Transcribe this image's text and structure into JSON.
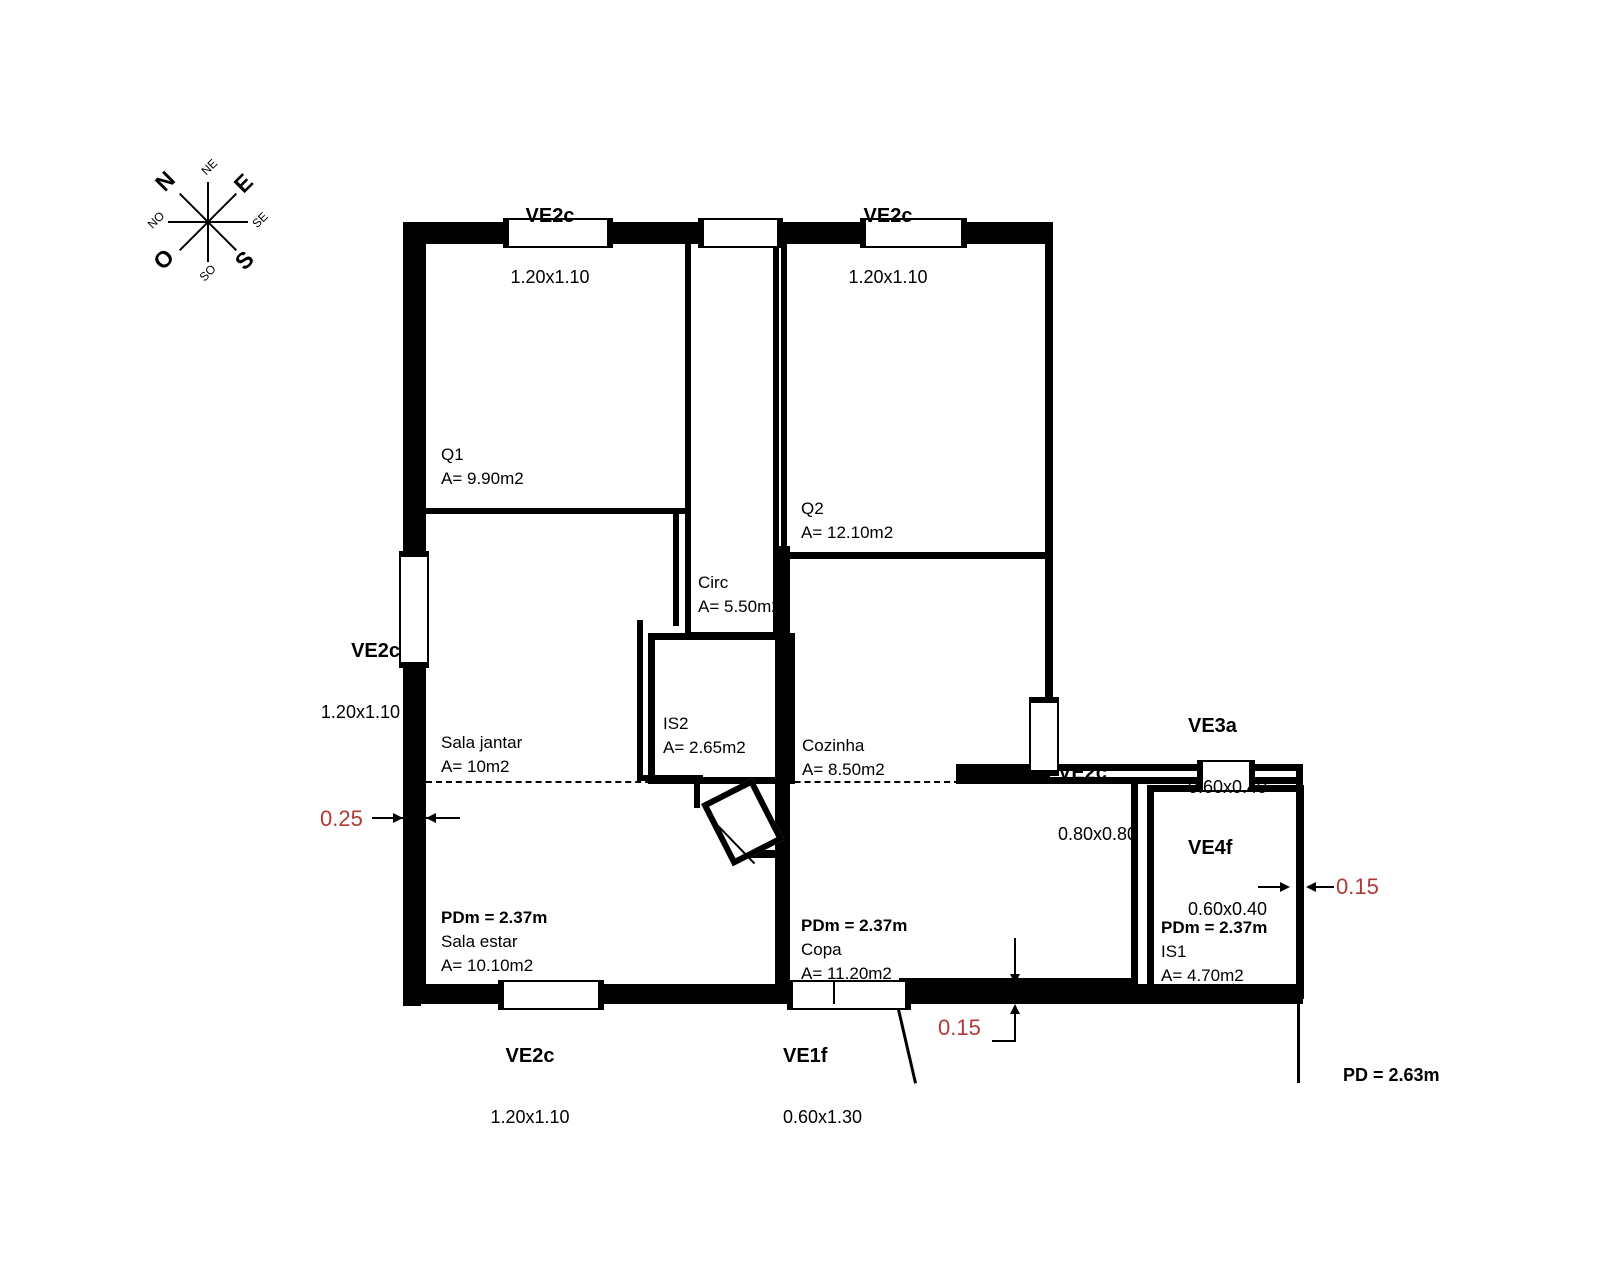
{
  "title": "Floor plan drawing",
  "compass": {
    "n": "N",
    "e": "E",
    "s": "S",
    "o": "O",
    "ne": "NE",
    "se": "SE",
    "so": "SO",
    "no": "NO"
  },
  "rooms": {
    "q1": {
      "name": "Q1",
      "area": "A= 9.90m2"
    },
    "q2": {
      "name": "Q2",
      "area": "A= 12.10m2"
    },
    "circ": {
      "name": "Circ",
      "area": "A= 5.50m2"
    },
    "is2": {
      "name": "IS2",
      "area": "A= 2.65m2"
    },
    "cozinha": {
      "name": "Cozinha",
      "area": "A= 8.50m2"
    },
    "sala_jantar": {
      "name": "Sala jantar",
      "area": "A= 10m2"
    },
    "sala_estar": {
      "pdm": "PDm = 2.37m",
      "name": "Sala estar",
      "area": "A= 10.10m2"
    },
    "copa": {
      "pdm": "PDm = 2.37m",
      "name": "Copa",
      "area": "A= 11.20m2"
    },
    "is1": {
      "pdm": "PDm = 2.37m",
      "name": "IS1",
      "area": "A= 4.70m2"
    }
  },
  "windows": {
    "top_left": {
      "code": "VE2c",
      "size": "1.20x1.10"
    },
    "top_right": {
      "code": "VE2c",
      "size": "1.20x1.10"
    },
    "left": {
      "code": "VE2c",
      "size": "1.20x1.10"
    },
    "bottom_left": {
      "code": "VE2c",
      "size": "1.20x1.10"
    },
    "entrance": {
      "code": "VE1f",
      "size": "0.60x1.30"
    },
    "east": {
      "code": "VE2c",
      "size": "0.80x0.80"
    },
    "ve3a": {
      "code": "VE3a",
      "size": "0.60x0.40"
    },
    "ve4f": {
      "code": "VE4f",
      "size": "0.60x0.40"
    }
  },
  "dimensions": {
    "left_wall": "0.25",
    "bottom_wall": "0.15",
    "right_wall": "0.15",
    "ceiling_height": "PD = 2.63m"
  },
  "colors": {
    "wall": "#000000",
    "dimension_red": "#b03a37",
    "background": "#ffffff"
  }
}
